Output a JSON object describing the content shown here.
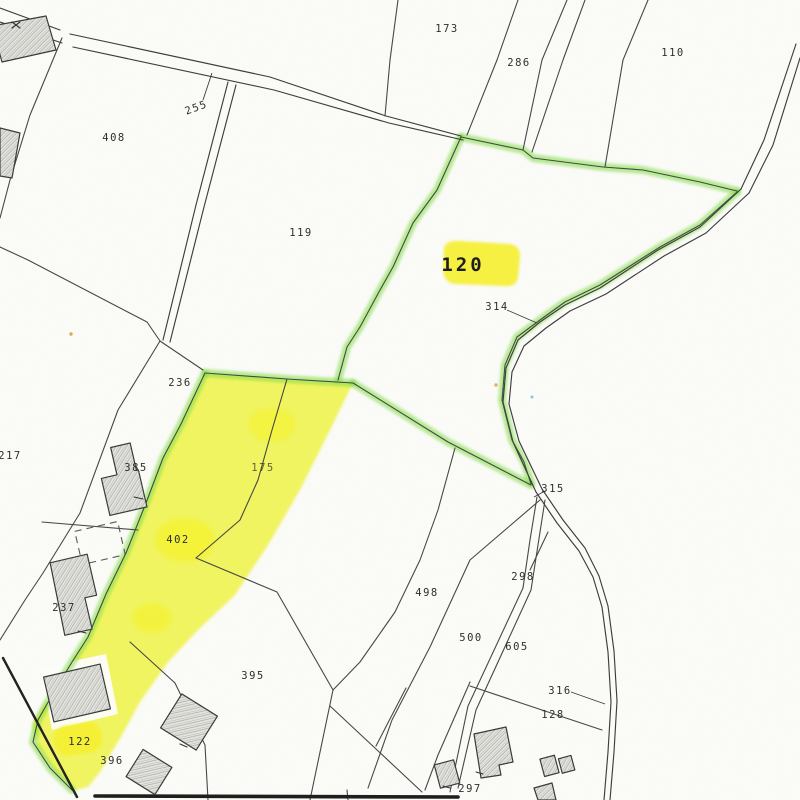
{
  "map": {
    "type": "cadastral-parcel-map-scan",
    "labels": [
      {
        "text": "173"
      },
      {
        "text": "286"
      },
      {
        "text": "110"
      },
      {
        "text": "255"
      },
      {
        "text": "408"
      },
      {
        "text": "119"
      },
      {
        "text": "120"
      },
      {
        "text": "314"
      },
      {
        "text": "236"
      },
      {
        "text": "217"
      },
      {
        "text": "385"
      },
      {
        "text": "175"
      },
      {
        "text": "402"
      },
      {
        "text": "237"
      },
      {
        "text": "315"
      },
      {
        "text": "298"
      },
      {
        "text": "498"
      },
      {
        "text": "500"
      },
      {
        "text": "605"
      },
      {
        "text": "316"
      },
      {
        "text": "128"
      },
      {
        "text": "395"
      },
      {
        "text": "122"
      },
      {
        "text": "396"
      },
      {
        "text": "297"
      }
    ],
    "colors": {
      "highlight_yellow": "#eef23c",
      "highlight_yellow_deep": "#f6ef2d",
      "highlight_green": "#7fdd45",
      "boundary_line": "#474747",
      "building_fill": "#e3e3df",
      "paper": "#fcfcf9"
    }
  }
}
